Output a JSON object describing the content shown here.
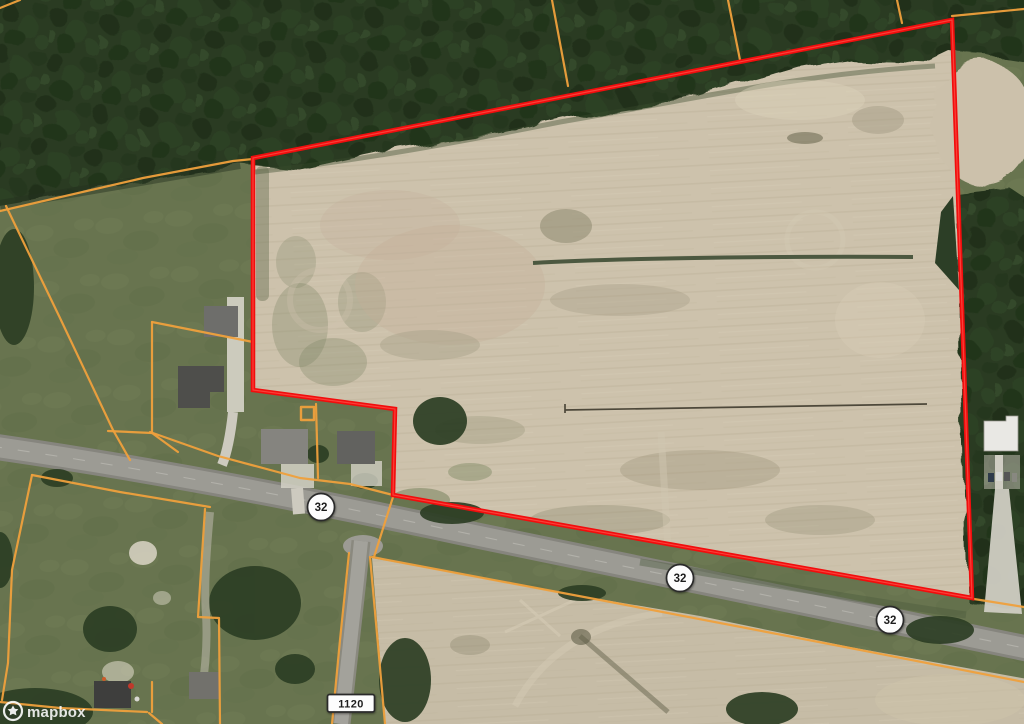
{
  "map": {
    "attribution_brand": "mapbox",
    "route_shields": {
      "nc32": "32",
      "sr1120": "1120"
    },
    "colors": {
      "boundary_red": "#f20d0d",
      "parcel_orange": "#efa03c",
      "shield_fill": "#fdfdfd",
      "shield_border": "#2b2b2b",
      "shield_text": "#1f1f1f"
    }
  }
}
